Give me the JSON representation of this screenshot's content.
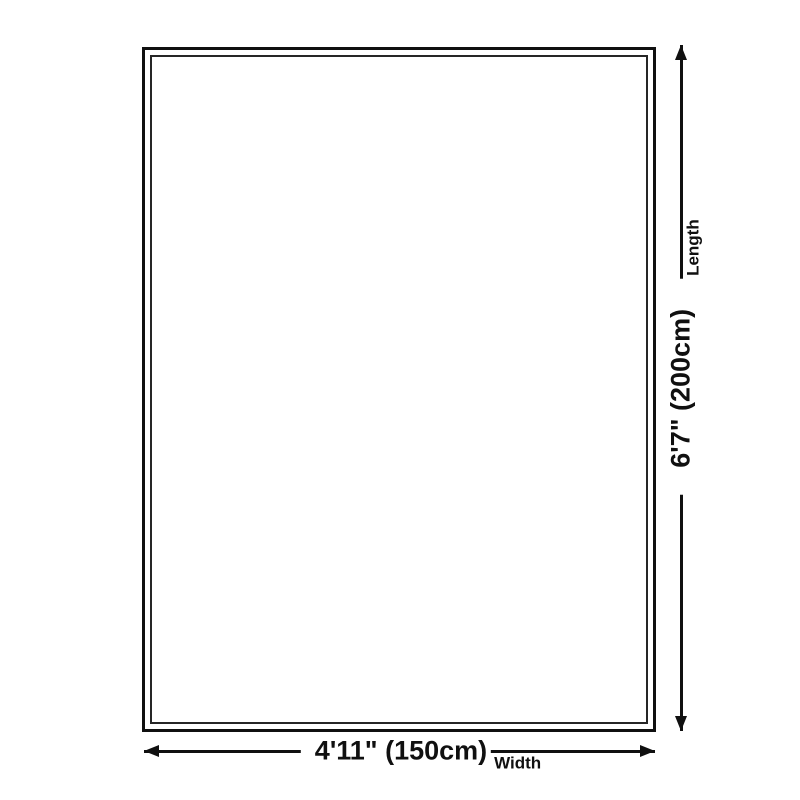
{
  "diagram": {
    "background_color": "#ffffff",
    "line_color": "#101010",
    "rug": {
      "fill": "#ffffff",
      "outer_border_color": "#101010",
      "inner_border_color": "#262626"
    },
    "dimensions": {
      "length": {
        "value": "6'7\" (200cm)",
        "label": "Length"
      },
      "width": {
        "value": "4'11\" (150cm)",
        "label": "Width"
      }
    }
  }
}
